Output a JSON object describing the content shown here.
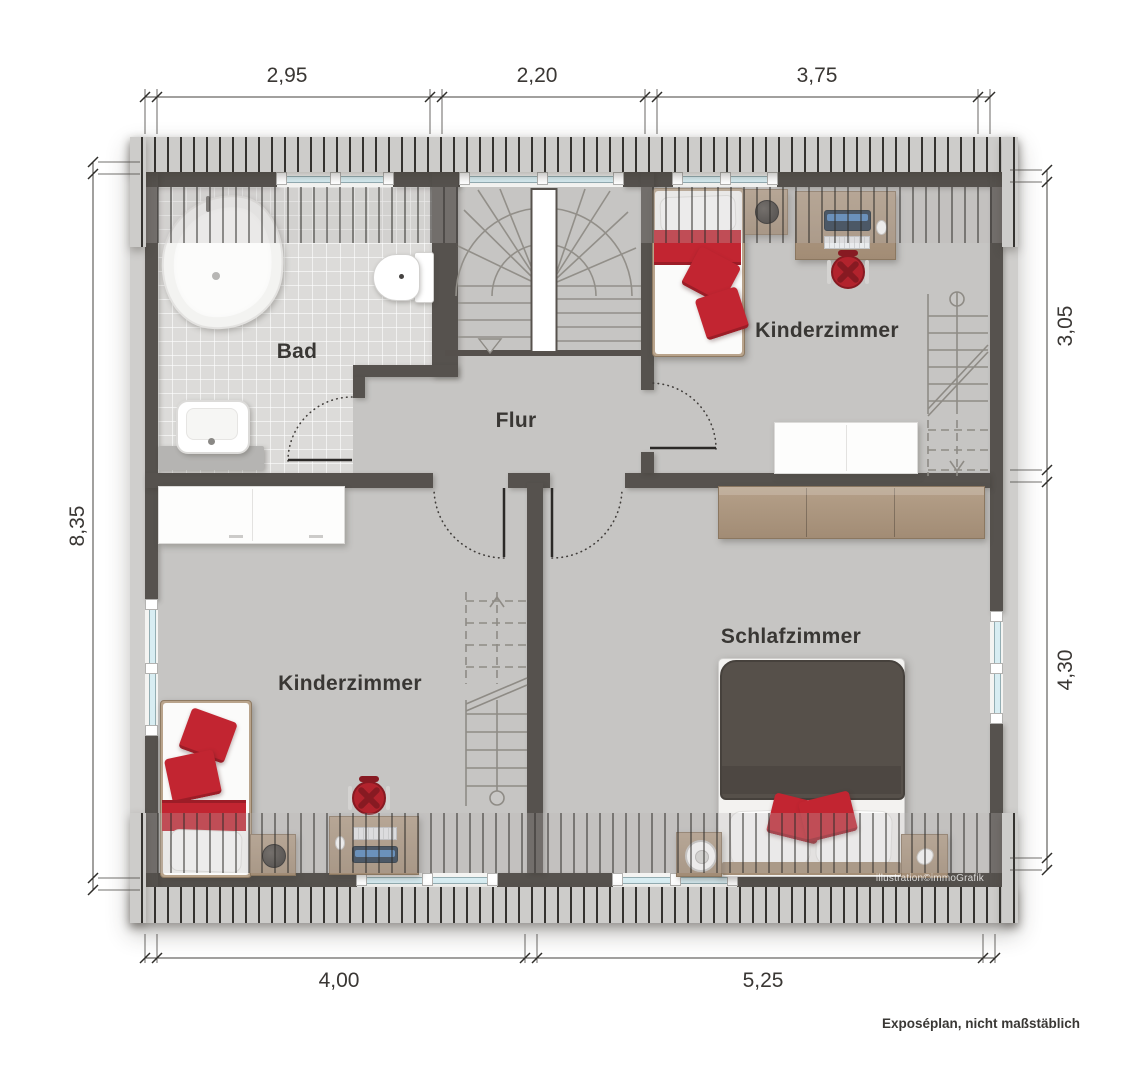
{
  "rooms": {
    "bad": "Bad",
    "flur": "Flur",
    "kinderzimmer_top": "Kinderzimmer",
    "kinderzimmer_bottom": "Kinderzimmer",
    "schlafzimmer": "Schlafzimmer"
  },
  "dimensions": {
    "top": [
      "2,95",
      "2,20",
      "3,75"
    ],
    "bottom": [
      "4,00",
      "5,25"
    ],
    "left": [
      "8,35"
    ],
    "right": [
      "3,05",
      "4,30"
    ]
  },
  "annotations": {
    "watermark": "illustration©immoGrafik",
    "footer": "Exposéplan, nicht maßstäblich"
  },
  "colors": {
    "wall": "#56524e",
    "floor": "#c6c5c3",
    "bath_tile": "#dcdbd9",
    "hatch_base": "#cdccca",
    "hatch_stripe": "#34322f",
    "accent_red": "#c22531",
    "wood": "#ab947c",
    "duvet": "#56504a",
    "window_glass": "#d8edf2",
    "stair_line": "#928f89",
    "text": "#393734"
  }
}
